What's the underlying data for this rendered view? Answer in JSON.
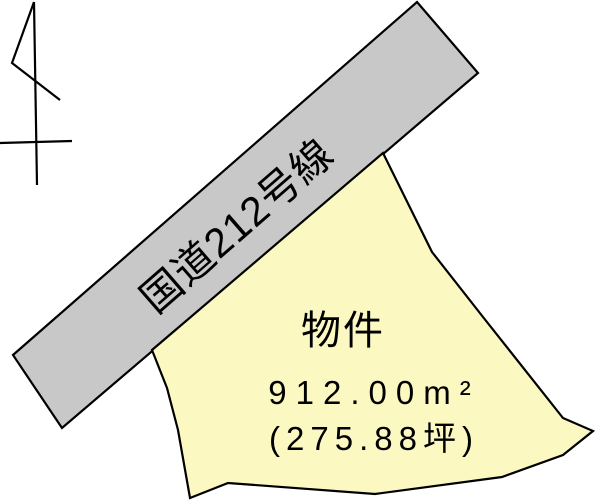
{
  "diagram": {
    "background": "#ffffff",
    "outline_color": "#000000"
  },
  "road": {
    "label": "国道212号線",
    "fill": "#c8c8c8",
    "outline": "#000000",
    "points": "417,2 478,73 62,428 13,355"
  },
  "property": {
    "name": "物件",
    "area_sqm": "912.00m²",
    "area_tsubo": "(275.88坪)",
    "fill": "#fbf8c1",
    "outline": "#000000",
    "points": "383,153 432,252 483,317 563,418 593,431 563,455 502,477 375,494 228,483 190,498 178,430 167,388 152,350"
  },
  "north_arrow": {
    "color": "#000000",
    "staff": "34,2 37,185",
    "flag": "34,2 12,63 60,100",
    "crossbar": "0,143 72,141"
  }
}
